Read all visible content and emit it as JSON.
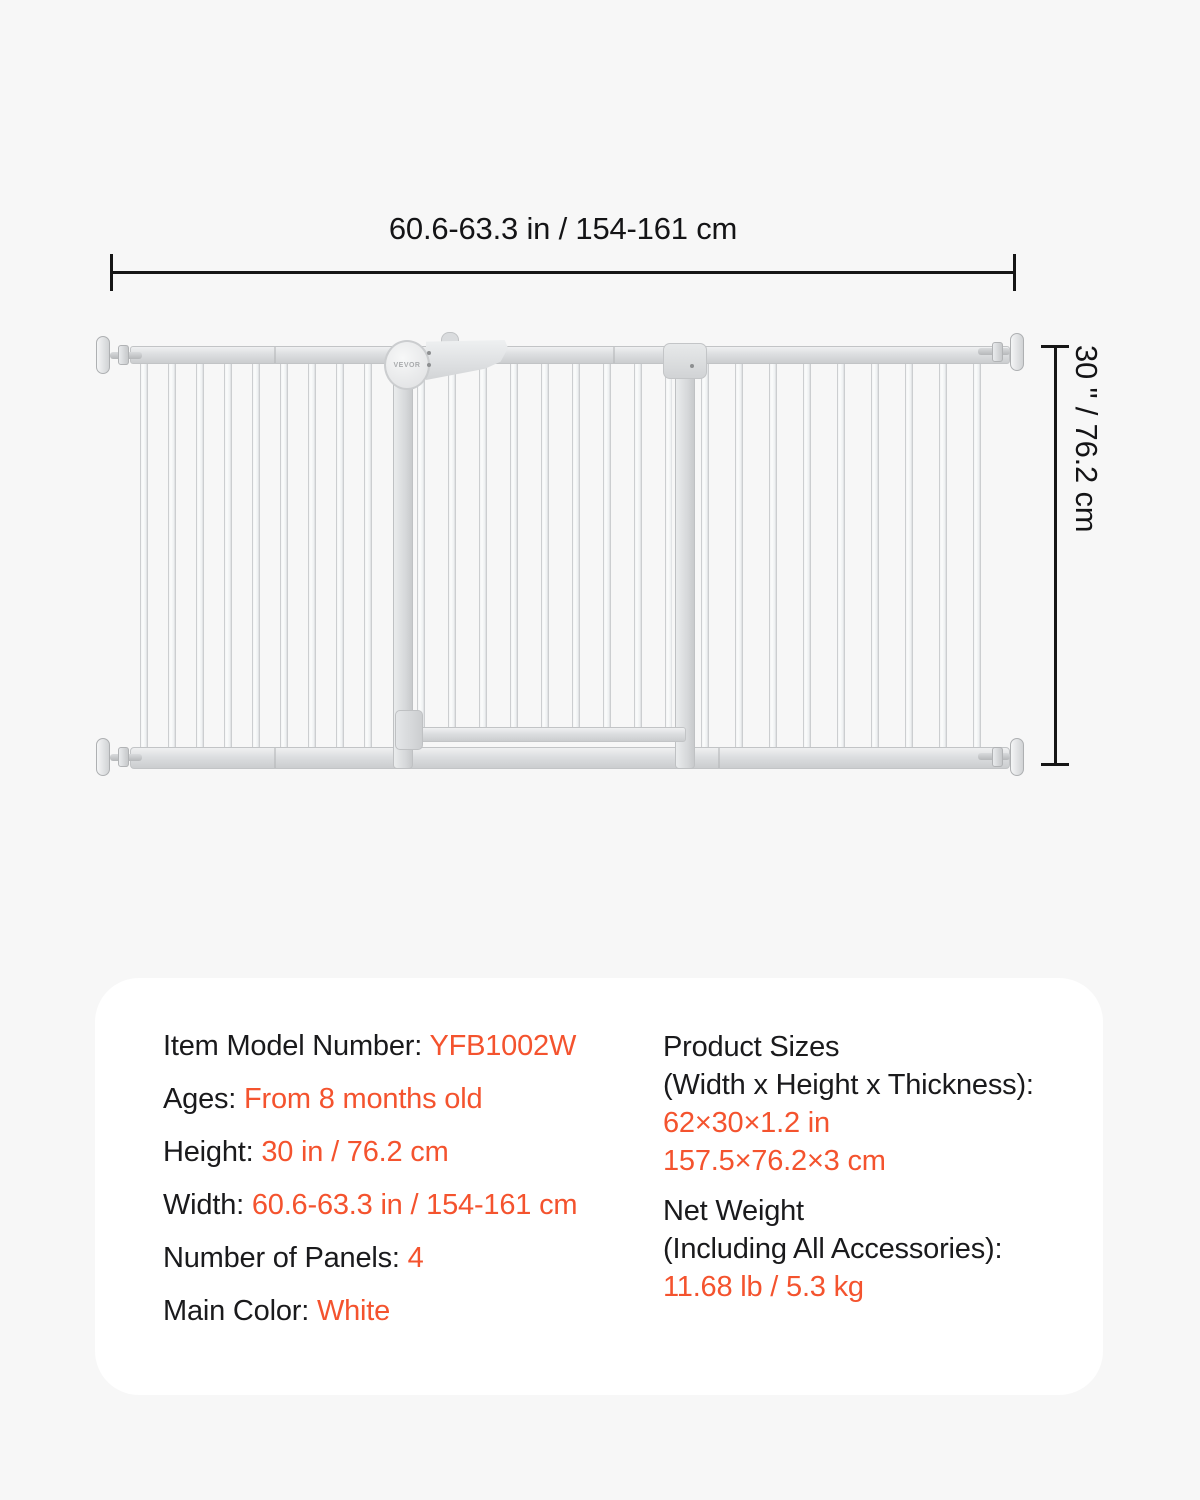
{
  "dimensions": {
    "width_label": "60.6-63.3 in / 154-161 cm",
    "height_label": "30 \" / 76.2 cm"
  },
  "illustration": {
    "description": "white metal pressure-mounted baby gate with 4 panels and walk-through door",
    "brand_logo": "VEVOR",
    "gate_color_hex": "#e8eaec"
  },
  "specs": {
    "left": [
      {
        "label": "Item Model Number: ",
        "value": "YFB1002W"
      },
      {
        "label": "Ages: ",
        "value": "From 8 months old"
      },
      {
        "label": "Height: ",
        "value": "30 in / 76.2 cm"
      },
      {
        "label": "Width: ",
        "value": "60.6-63.3 in / 154-161 cm"
      },
      {
        "label": "Number of Panels: ",
        "value": "4"
      },
      {
        "label": "Main Color: ",
        "value": "White"
      }
    ],
    "right": [
      {
        "label_lines": [
          "Product Sizes",
          "(Width x Height x Thickness):"
        ],
        "value_lines": [
          "62×30×1.2 in",
          "157.5×76.2×3 cm"
        ]
      },
      {
        "label_lines": [
          "Net Weight",
          "(Including All Accessories):"
        ],
        "value_lines": [
          "11.68 lb / 5.3 kg"
        ]
      }
    ]
  },
  "colors": {
    "background": "#f7f7f7",
    "panel": "#ffffff",
    "text_black": "#1a1a1c",
    "accent_orange": "#f4532e",
    "dimension_line": "#161616"
  }
}
